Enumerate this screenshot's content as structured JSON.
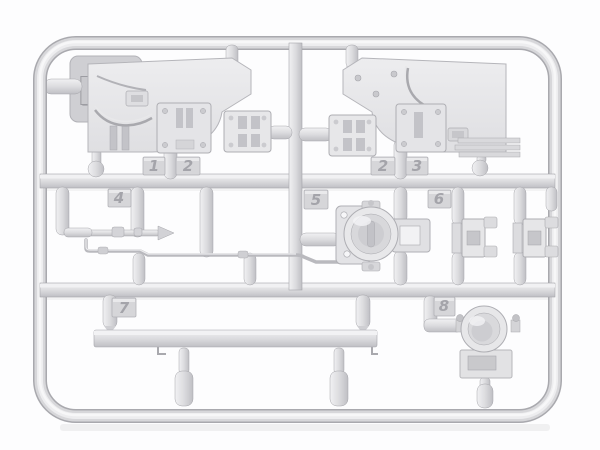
{
  "sprue": {
    "code_label": "Dv",
    "tags": [
      {
        "id": "tag-1-left",
        "label": "1"
      },
      {
        "id": "tag-2-left",
        "label": "2"
      },
      {
        "id": "tag-2-right",
        "label": "2"
      },
      {
        "id": "tag-3-right",
        "label": "3"
      },
      {
        "id": "tag-4",
        "label": "4"
      },
      {
        "id": "tag-5",
        "label": "5"
      },
      {
        "id": "tag-6",
        "label": "6"
      },
      {
        "id": "tag-7",
        "label": "7"
      },
      {
        "id": "tag-8",
        "label": "8"
      }
    ]
  },
  "colors": {
    "background": "#fdfdfe",
    "plastic_base": "#d9d9dc",
    "plastic_light": "#f2f2f4",
    "plastic_mid": "#e6e6e8",
    "plastic_dark": "#bfbfc4",
    "outline": "#a6a6ab",
    "tag_number": "#a4a4aa"
  }
}
